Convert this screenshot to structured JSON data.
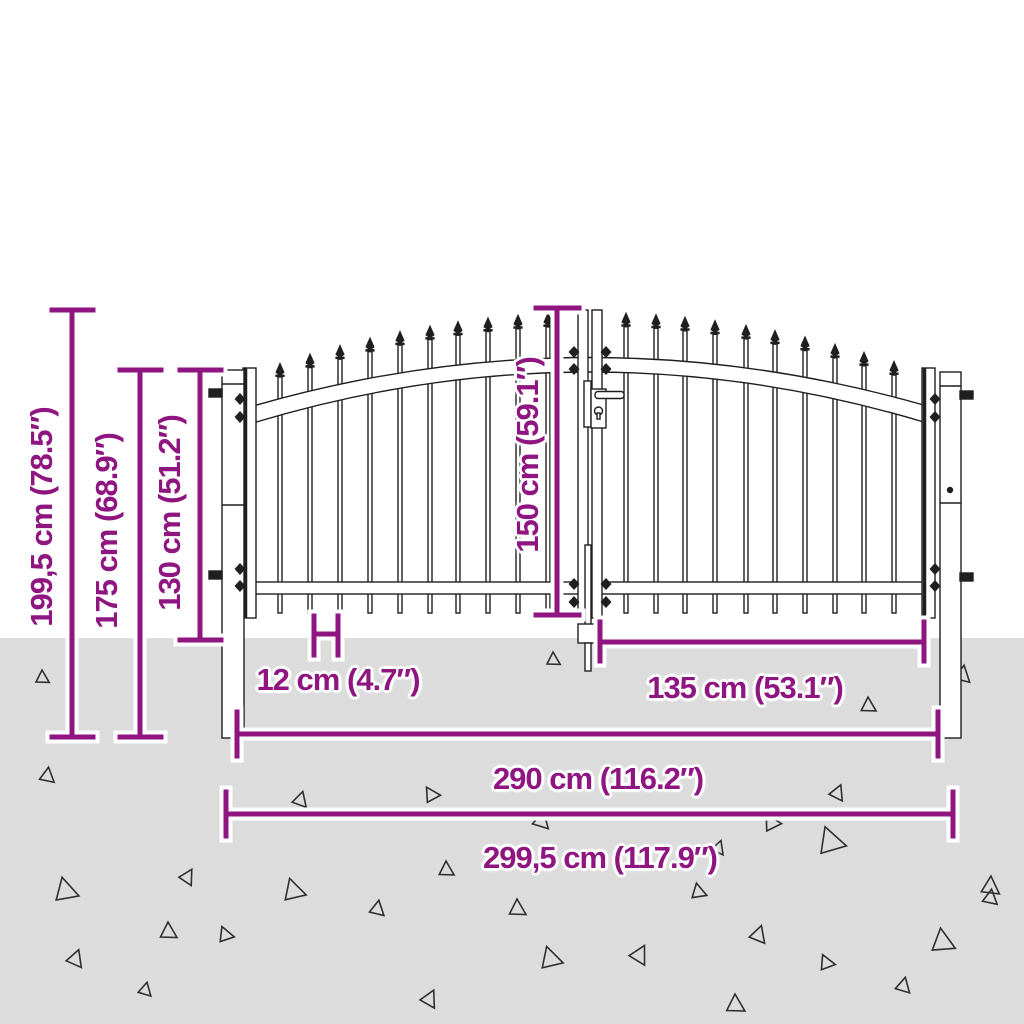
{
  "title": "Double door garden gate with spear top — dimension diagram",
  "colors": {
    "accent": "#8f1580",
    "ground": "#dcdcdc",
    "line": "#1f1f1f",
    "halo": "#ffffff"
  },
  "dimensions": {
    "total_height": "199,5 cm (78.5″)",
    "post_height": "175 cm (68.9″)",
    "fence_height": "130 cm (51.2″)",
    "door_height": "150 cm (59.1″)",
    "picket_gap": "12 cm (4.7″)",
    "door_width": "135 cm (53.1″)",
    "inner_width": "290 cm (116.2″)",
    "total_width": "299,5 cm (117.9″)"
  }
}
